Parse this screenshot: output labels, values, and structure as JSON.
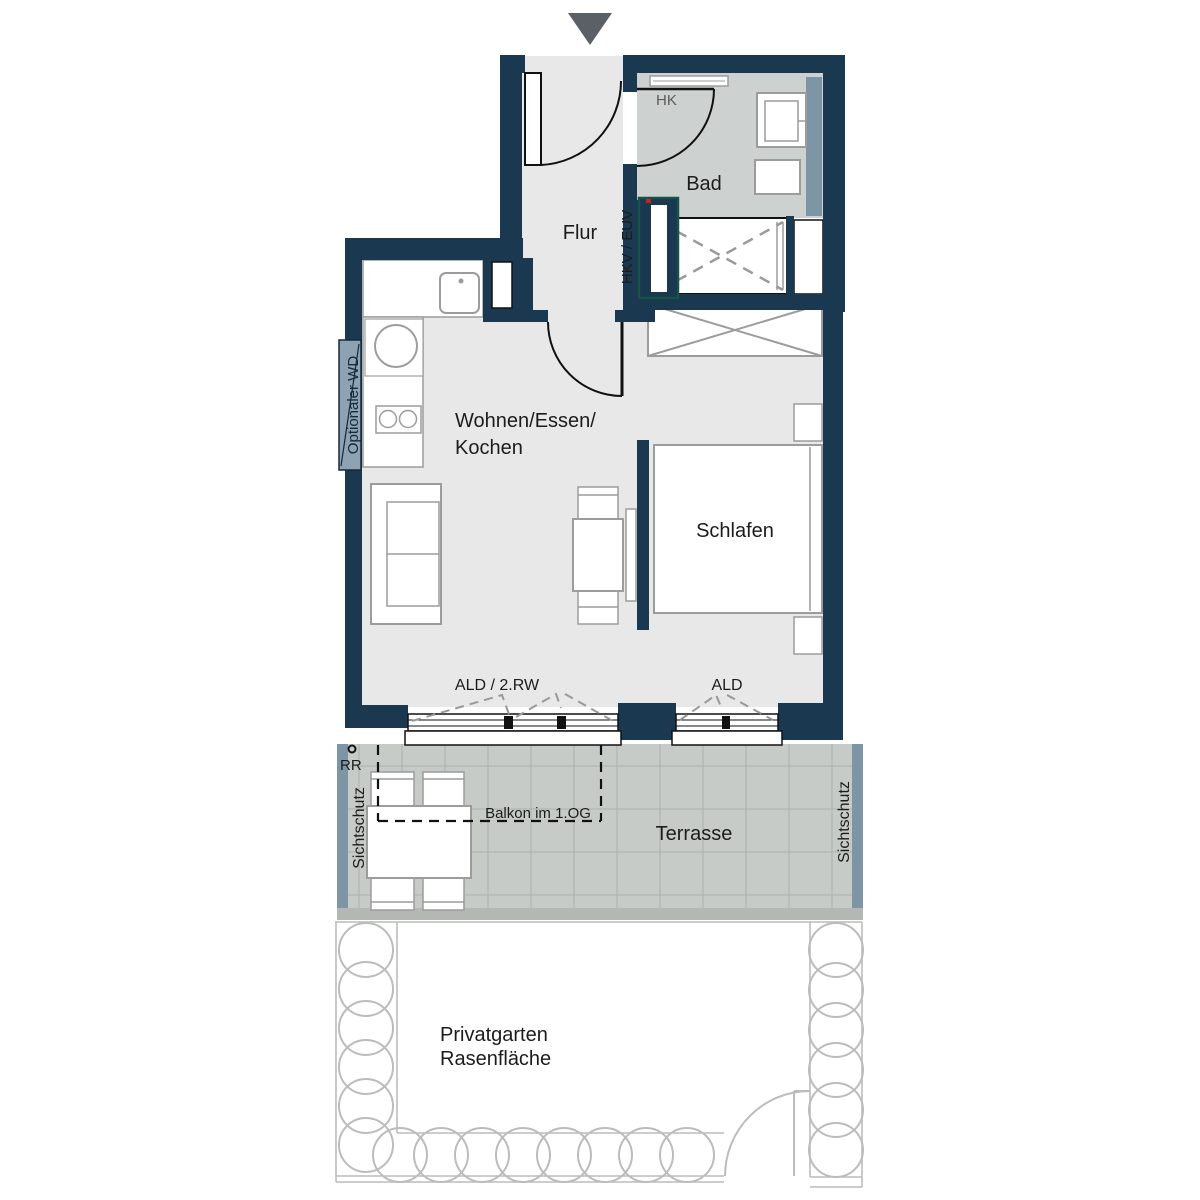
{
  "plan": {
    "title_hint": "apartment floor plan",
    "icons": {
      "entrance": "entrance-arrow-down-triangle",
      "rain_pipe_marker": "small-circle"
    },
    "rooms": {
      "hall": "Flur",
      "bath": "Bad",
      "bedroom": "Schlafen",
      "living_line1": "Wohnen/Essen/",
      "living_line2": "Kochen"
    },
    "outdoor": {
      "terrace": "Terrasse",
      "balcony_above": "Balkon im 1.OG",
      "garden_line1": "Privatgarten",
      "garden_line2": "Rasenfläche",
      "privacy_left": "Sichtschutz",
      "privacy_right": "Sichtschutz"
    },
    "annotations": {
      "radiator": "HK",
      "utility_cabinet": "HKV / EUV",
      "optional_washer_dryer": "Optionaler WD",
      "window_left": "ALD / 2.RW",
      "window_right": "ALD",
      "rain_pipe": "RR"
    },
    "colors": {
      "wall": "#1a384f",
      "floor": "#e7e8e7",
      "bath_floor": "#cdd2d1",
      "terrace": "#c6cbc7",
      "terrace_grid": "#aab0ab",
      "terrace_edge": "#b4b8b4",
      "privacy_screen": "#7e95a6",
      "washer_box": "#8da2b2",
      "utility_outline": "#155247",
      "utility_dot": "#c2271b",
      "hedge": "#bcbcbc",
      "furniture_outline": "#9c9c9c",
      "entrance_arrow": "#5a6065"
    }
  }
}
